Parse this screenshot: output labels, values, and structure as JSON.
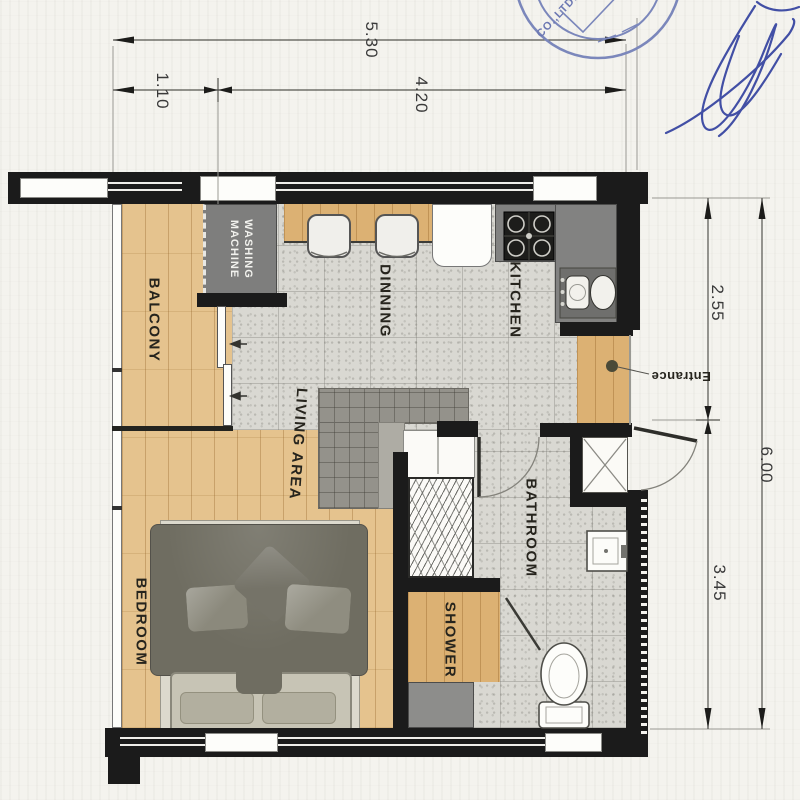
{
  "plan": {
    "title": "condo-unit-floor-plan",
    "labels": {
      "balcony": "BALCONY",
      "washing_machine": "WASHING\nMACHINE",
      "dinning": "DINNING",
      "kitchen": "KITCHEN",
      "living_area": "LIVING AREA",
      "bedroom": "BEDROOM",
      "bathroom": "BATHROOM",
      "shower": "SHOWER",
      "entrance": "Entrance"
    },
    "dimensions": {
      "top_total": "5.30",
      "top_left": "1.10",
      "top_right": "4.20",
      "right_upper": "2.55",
      "right_lower": "3.45",
      "right_total": "6.00"
    },
    "stamp": {
      "company": "CO.,LTD."
    },
    "colors": {
      "wall": "#1b1b1b",
      "wood": "#e5c38e",
      "wood_dark": "#dcb173",
      "tile": "#d9d8d2",
      "counter_gray": "#828281",
      "stamp_blue": "#7b87bb",
      "signature_blue": "#2f3e9e"
    }
  }
}
